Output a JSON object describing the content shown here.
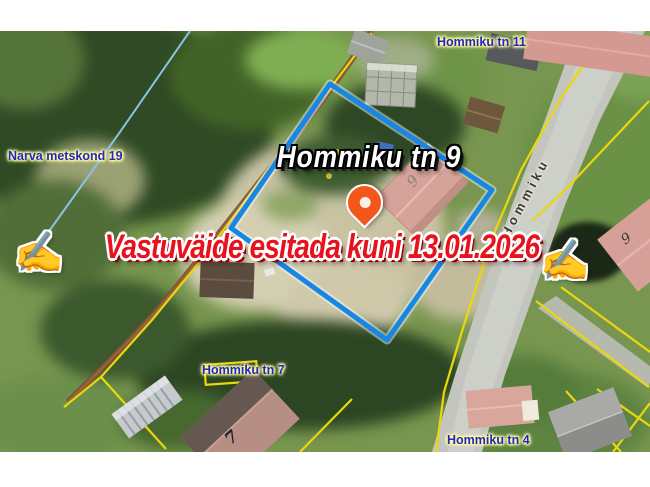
{
  "window": {
    "width": 650,
    "height": 487,
    "background": "#ffffff"
  },
  "map": {
    "type": "aerial-cadastral-map",
    "parcel_labels": [
      {
        "id": "narva-metskond-19",
        "text": "Narva metskond 19"
      },
      {
        "id": "hommiku-tn-11",
        "text": "Hommiku tn 11"
      },
      {
        "id": "hommiku-tn-7",
        "text": "Hommiku tn 7"
      },
      {
        "id": "hommiku-tn-4",
        "text": "Hommiku tn 4"
      }
    ],
    "road_label": {
      "text": "Hommiku"
    },
    "house_numbers": {
      "parcel": "9",
      "across_road": "9",
      "neighbor": "7"
    },
    "colors": {
      "label_blue": "#2424c8",
      "label_halo": "#ffffa0",
      "cadastral_yellow": "#ead70c",
      "boundary_light_blue": "#8ac2e2",
      "highlight_polygon_blue": "#1787e5",
      "road_gray": "#c4c5bf",
      "path_brown": "#7e5134"
    }
  },
  "overlay": {
    "title": {
      "text": "Hommiku tn 9",
      "fill": "#ffffff",
      "outline": "#000000"
    },
    "banner": {
      "text": "Vastuväide esitada kuni 13.01.2026",
      "icon_name": "writing-hand-icon",
      "icon_glyph": "✍",
      "fill": "#e8121e",
      "outline": "#ffffff",
      "shadow": "#8c020c"
    },
    "marker": {
      "name": "location-pin",
      "color": "#f4571c"
    }
  }
}
